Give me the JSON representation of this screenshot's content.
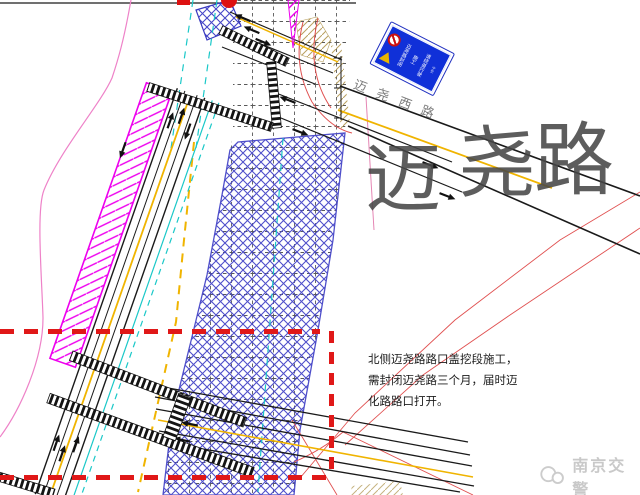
{
  "drawing": {
    "title_watermark": {
      "char1": "迈",
      "char2": "尧",
      "char3": "路"
    },
    "road_label": "迈尧西路",
    "sign": {
      "line1": "迈尧路封闭",
      "line2": "施工",
      "line3": "请绕道行驶",
      "panel_color": "#1030d8"
    },
    "annotation": {
      "line1": "北侧迈尧路路口盖挖段施工，",
      "line2": "需封闭迈尧路三个月，届时迈",
      "line3": "化路路口打开。"
    },
    "footer": {
      "brand": "南京交警"
    },
    "colors": {
      "closure_dash_red": "#e01818",
      "construction_hatch_blue": "#4646c8",
      "barrier_magenta": "#ee00ee",
      "lane_yellow": "#f0b400",
      "guide_cyan": "#1ac8c8",
      "edge_pink": "#e586b4",
      "island_tan": "#b8a060",
      "watermark_grey": "#c9c9c9",
      "text_dark": "#1c1c1c"
    }
  }
}
